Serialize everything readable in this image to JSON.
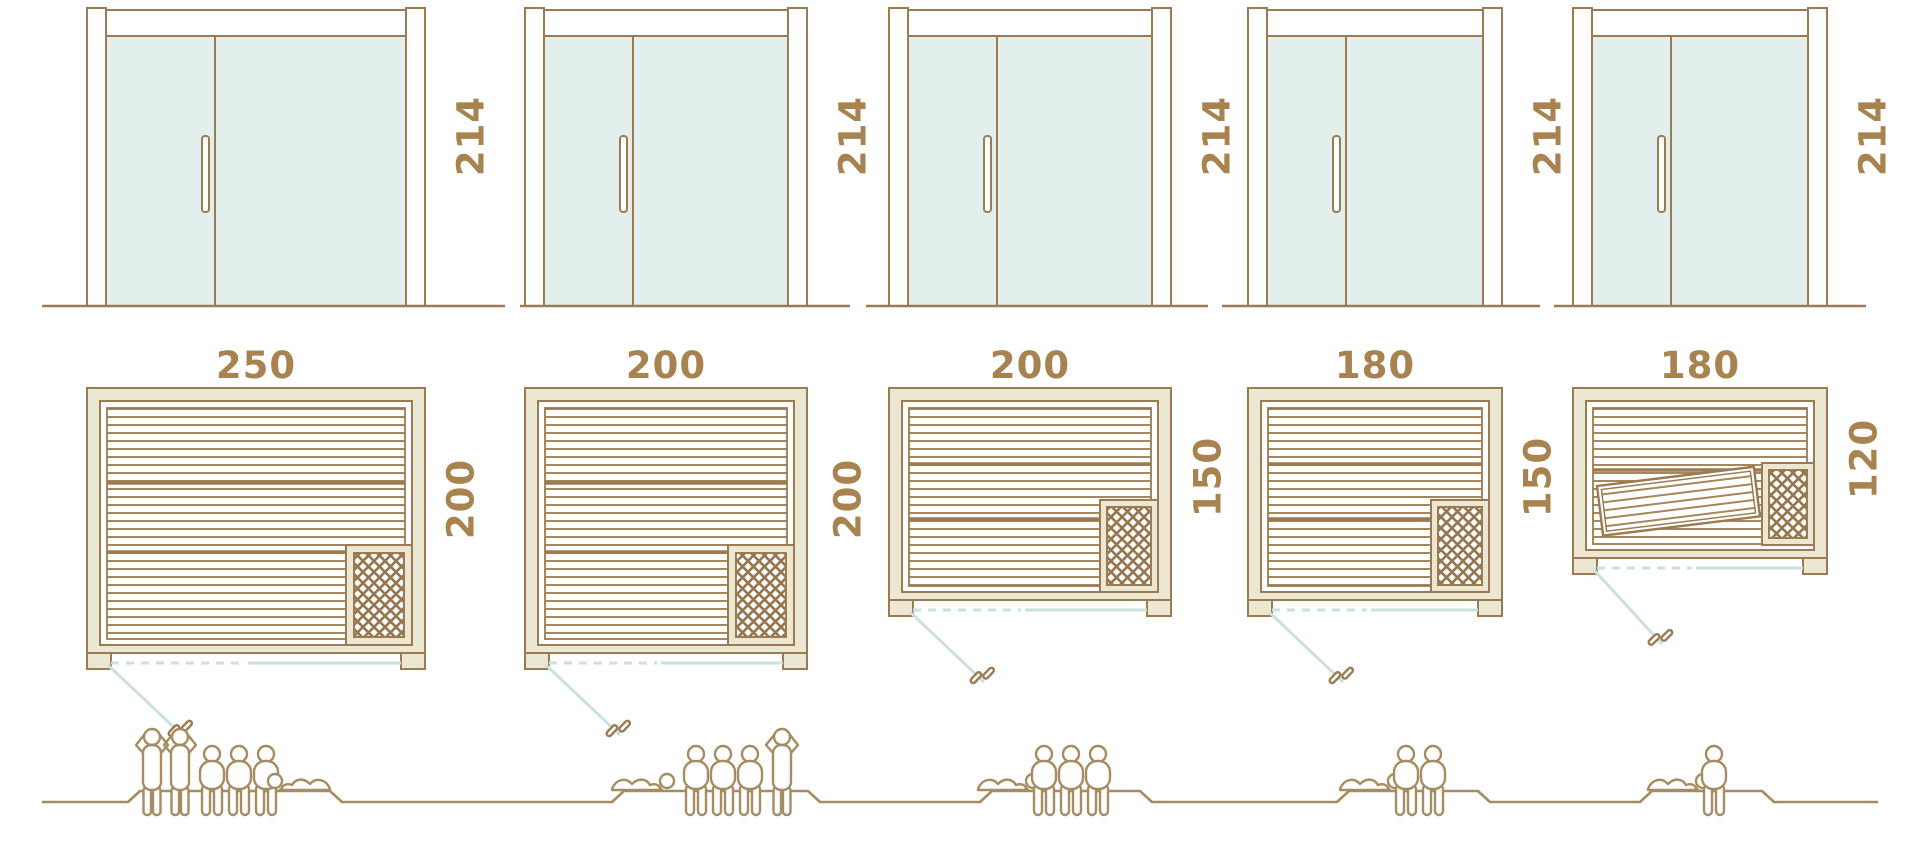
{
  "diagram_title": "sauna-size-comparison",
  "units": [
    {
      "id": "unit-1",
      "door_height_cm": "214",
      "plan_width_cm": "250",
      "plan_depth_cm": "200",
      "capacity_people": 6,
      "people": {
        "standing": 2,
        "sitting": 3,
        "lying": 1
      }
    },
    {
      "id": "unit-2",
      "door_height_cm": "214",
      "plan_width_cm": "200",
      "plan_depth_cm": "200",
      "capacity_people": 5,
      "people": {
        "standing": 1,
        "sitting": 3,
        "lying": 1
      }
    },
    {
      "id": "unit-3",
      "door_height_cm": "214",
      "plan_width_cm": "200",
      "plan_depth_cm": "150",
      "capacity_people": 4,
      "people": {
        "standing": 0,
        "sitting": 3,
        "lying": 1
      }
    },
    {
      "id": "unit-4",
      "door_height_cm": "214",
      "plan_width_cm": "180",
      "plan_depth_cm": "150",
      "capacity_people": 3,
      "people": {
        "standing": 0,
        "sitting": 2,
        "lying": 1
      }
    },
    {
      "id": "unit-5",
      "door_height_cm": "214",
      "plan_width_cm": "180",
      "plan_depth_cm": "120",
      "capacity_people": 2,
      "people": {
        "standing": 0,
        "sitting": 1,
        "lying": 1
      }
    }
  ],
  "colors": {
    "outline_brown": "#9a7b52",
    "slat_brown": "#a6875d",
    "wall_cream": "#ebe7d3",
    "glass_fill": "#e3efec",
    "glass_line": "#c9e2dd",
    "label_text": "#a8824f",
    "figure_outline": "#a58c63"
  }
}
